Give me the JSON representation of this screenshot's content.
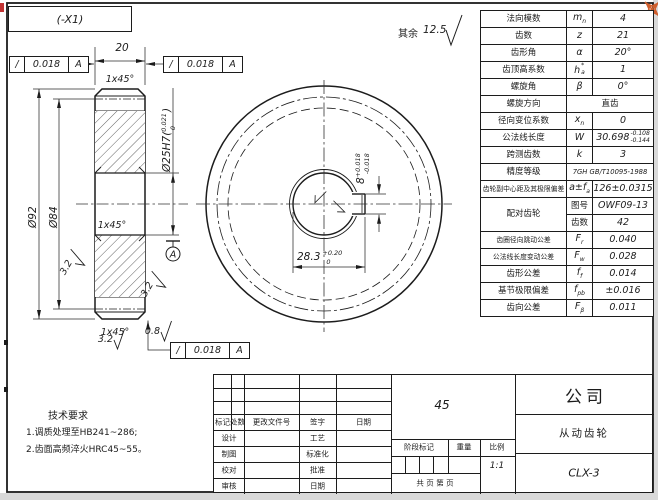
{
  "window": {
    "tab_label": "(-X1)"
  },
  "general_roughness": {
    "prefix": "其余",
    "value": "12.5"
  },
  "tolerances": {
    "top_left": {
      "symbol": "/",
      "value": "0.018",
      "datum": "A"
    },
    "top_right": {
      "symbol": "/",
      "value": "0.018",
      "datum": "A"
    },
    "bottom": {
      "symbol": "/",
      "value": "0.018",
      "datum": "A"
    }
  },
  "left_view": {
    "width": "20",
    "chamfer_top": "1x45°",
    "chamfer_bore": "1x45°",
    "chamfer_bottom": "1x45°",
    "bore": {
      "prefix": "Ø25H7(",
      "upper": "0.021",
      "lower": "0",
      "suffix": ")"
    },
    "outer_dia": "Ø92",
    "pitch_dia": "Ø84",
    "datum_label": "A",
    "roughness_left": "3.2",
    "roughness_right": "3.2",
    "roughness_bottom": "3.2",
    "roughness_bore": "0.8"
  },
  "right_view": {
    "keyway_width": {
      "nominal": "8",
      "upper": "+0.018",
      "lower": "-0.018"
    },
    "keyway_depth": {
      "nominal": "28.3",
      "upper": "+0.20",
      "lower": "0"
    }
  },
  "gear_table": {
    "rows": [
      {
        "name": "法向模数",
        "sym": "m",
        "sym_sub": "n",
        "val": "4"
      },
      {
        "name": "齿数",
        "sym": "z",
        "val": "21"
      },
      {
        "name": "齿形角",
        "sym": "α",
        "val": "20°"
      },
      {
        "name": "齿顶高系数",
        "sym": "h",
        "sym_sup": "*",
        "sym_sub": "a",
        "val": "1"
      },
      {
        "name": "螺旋角",
        "sym": "β",
        "val": "0°"
      },
      {
        "name": "螺旋方向",
        "val": "直齿",
        "merged": true
      },
      {
        "name": "径向变位系数",
        "sym": "x",
        "sym_sub": "n",
        "val": "0"
      },
      {
        "name": "公法线长度",
        "sym": "W",
        "val": "30.698",
        "val_sup": "-0.108",
        "val_sub": "-0.144"
      },
      {
        "name": "跨测齿数",
        "sym": "k",
        "val": "3"
      },
      {
        "name": "精度等级",
        "val": "7GH GB/T10095-1988",
        "merged": true
      },
      {
        "name": "齿轮副中心距及其极限偏差",
        "sym": "a±f",
        "sym_sub": "a",
        "val": "126±0.0315"
      },
      {
        "name": "配对齿轮",
        "sub_rows": [
          {
            "label": "图号",
            "val": "OWF09-13"
          },
          {
            "label": "齿数",
            "val": "42"
          }
        ]
      },
      {
        "name": "齿圈径向跳动公差",
        "sym": "F",
        "sym_sub": "r",
        "val": "0.040"
      },
      {
        "name": "公法线长度变动公差",
        "sym": "F",
        "sym_sub": "w",
        "val": "0.028"
      },
      {
        "name": "齿形公差",
        "sym": "f",
        "sym_sub": "f",
        "val": "0.014"
      },
      {
        "name": "基节极限偏差",
        "sym": "f",
        "sym_sub": "pb",
        "val": "±0.016"
      },
      {
        "name": "齿向公差",
        "sym": "F",
        "sym_sub": "β",
        "val": "0.011"
      }
    ]
  },
  "tech_requirements": {
    "title": "技术要求",
    "lines": [
      "1.调质处理至HB241~286;",
      "2.齿面高频淬火HRC45~55。"
    ]
  },
  "title_block": {
    "revision_header": [
      "标记",
      "处数",
      "更改文件号",
      "签字",
      "日期"
    ],
    "roles": [
      {
        "left": "设计",
        "right": "工艺"
      },
      {
        "left": "制图",
        "right": "标准化"
      },
      {
        "left": "校对",
        "right": "批准"
      },
      {
        "left": "审核",
        "right": "日期"
      }
    ],
    "material": "45",
    "stage_header": [
      "阶段标记",
      "重量",
      "比例"
    ],
    "scale": "1:1",
    "pages_text": "共  页    第  页",
    "company": "公司",
    "part_name": "从动齿轮",
    "drawing_no": "CLX-3"
  },
  "colors": {
    "line": "#1c1c1c",
    "move_icon": "#cf5f2e",
    "corner_mark": "#c23333"
  }
}
